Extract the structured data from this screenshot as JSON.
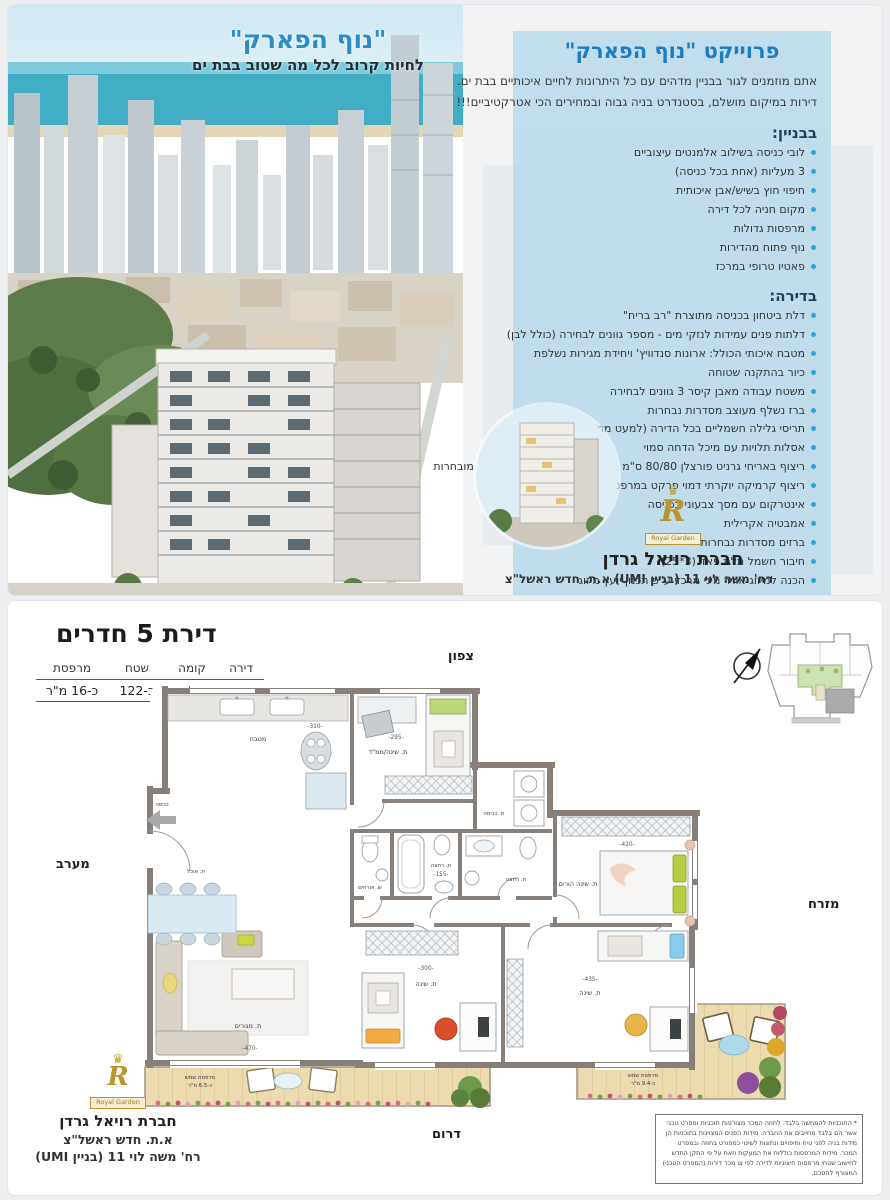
{
  "photo": {
    "title": "\"נוף הפארק\"",
    "subtitle": "לחיות קרוב לכל מה שטוב בבת ים"
  },
  "panel": {
    "title": "פרוייקט \"נוף הפארק\"",
    "intro1": "אתם מוזמנים לגור בבניין מדהים עם כל היתרונות לחיים איכותיים בבת ים.",
    "intro2": "דירות במיקום מושלם, בסטנדרט בניה גבוה ובמחירים הכי אטרקטיביים!!!",
    "building_title": "בבניין:",
    "building_items": [
      "לובי כניסה בשילוב אלמנטים עיצוביים",
      "3 מעליות (אחת בכל כניסה)",
      "חיפוי חוץ בשיש/אבן איכותית",
      "מקום חניה לכל דירה",
      "מרפסות גדולות",
      "נוף פתוח מהדירות",
      "פאטיו טרופי במרכז"
    ],
    "apartment_title": "בדירה:",
    "apartment_items": [
      "דלת ביטחון בכניסה מתוצרת \"רב בריח\"",
      "דלתות פנים עמידות לנזקי מים - מספר גוונים לבחירה (כולל לבן)",
      "מטבח איכותי הכולל: ארונות סנדוויץ' ויחידת מגירות נשלפת",
      "כיור בהתקנה שטוחה",
      "משטח עבודה מאבן קיסר 3 גוונים לבחירה",
      "ברז נשלף מעוצב מסדרות נבחרות",
      "תריסי גלילה חשמליים בכל הדירה (למעט ממ\"ד וחדרים רטובים)",
      "אסלות תלויות עם מיכל הדחה סמוי",
      "ריצוף באריחי גרניט פורצלן 80/80 ס\"מ במבחר גוונים לבחירה מסדרות מובחרות",
      "ריצוף קרמיקה יוקרתי דמוי פרקט במרפסות",
      "אינטרקום עם מסך צבעוני בכניסה",
      "אמבטיה אקרילית",
      "ברזים מסדרות נבחרות",
      "חיבור חשמל תלת פאזי (3*25)",
      "הכנה למיזוג אוויר מיני מרכזי ע\"פ תכנון יועץ מיזוג",
      "נקודות טלוויזיה וטלפון בכל חדר"
    ],
    "logo_monogram": "R",
    "logo_label": "Royal Garden",
    "logo_crown": "♛",
    "company_name": "חברת רויאל גרדן",
    "company_address": "רח' משה לוי 11 (בניין UMI) א.ת. חדש ראשל\"צ"
  },
  "floorplan": {
    "title": "דירת 5 חדרים",
    "table": {
      "headers": [
        "דירה",
        "קומה",
        "שטח",
        "מרפסת"
      ],
      "values": [
        "39",
        "5",
        "כ-122",
        "כ-16 מ\"ר"
      ]
    },
    "directions": {
      "north": "צפון",
      "west": "מערב",
      "east": "מזרח",
      "south": "דרום"
    },
    "rooms": {
      "kitchen": {
        "label": "מטבח",
        "dim": "-310-"
      },
      "mamad": {
        "label": "ת. שינה/ממ\"ד",
        "dim": "-295-"
      },
      "laundry": {
        "label": "ת. כביסה"
      },
      "entrance": {
        "label": "כניסה"
      },
      "dining": {
        "label": "ת. אוכל"
      },
      "living": {
        "label": "ת. מגורים",
        "dim": "-470-"
      },
      "master": {
        "label": "ת. שינה הורים",
        "dim": "-420-"
      },
      "bath1": {
        "label": "ת. רחצה",
        "dim": "-155-"
      },
      "bath2": {
        "label": "ת. רחצה"
      },
      "guest_wc": {
        "label": "ש. אורחים"
      },
      "bed2": {
        "label": "ת. שינה",
        "dim": "-300-"
      },
      "bed3": {
        "label": "ת. שינה",
        "dim": "-435-"
      },
      "balcony_left": {
        "label": "מרפסת שמש",
        "area": "כ-6.5 מ\"ר"
      },
      "balcony_right": {
        "label": "מרפסת שמש",
        "area": "כ-9.4 מ\"ר"
      }
    },
    "company_lines": [
      "חברת רויאל גרדן",
      "א.ת. חדש ראשל\"צ",
      "רח' משה לוי 11 (בניין UMI)"
    ],
    "disclaimer": "* התוכניות להמחשה בלבד. לחוזה המכר מצורפות תוכניות ומפרט טכני אשר הם בלבד מחייבים את החברה. מידות הפנים המצוינות בתוכניות הן מידות בניה לפני טיח וחיפויים ונתונות לשינוי כמפורט בחוזה ובמפרט המכר. מידות המרפסות כוללות את המעקות וזאת על פי התקן החדש לחישוב שטחי מרפסות חיצוניות לדירה לפי צו מכר דירות (המפרט הטכני) המצורף להסכם."
  },
  "colors": {
    "accent_blue": "#1d7dc4",
    "bullet_blue": "#29a8df",
    "panel_blue": "#b7d8e9",
    "wall": "#87807a",
    "wood": "#ecdbae",
    "keyplan_green": "#cde3b2",
    "logo_gold": "#b8962e"
  }
}
